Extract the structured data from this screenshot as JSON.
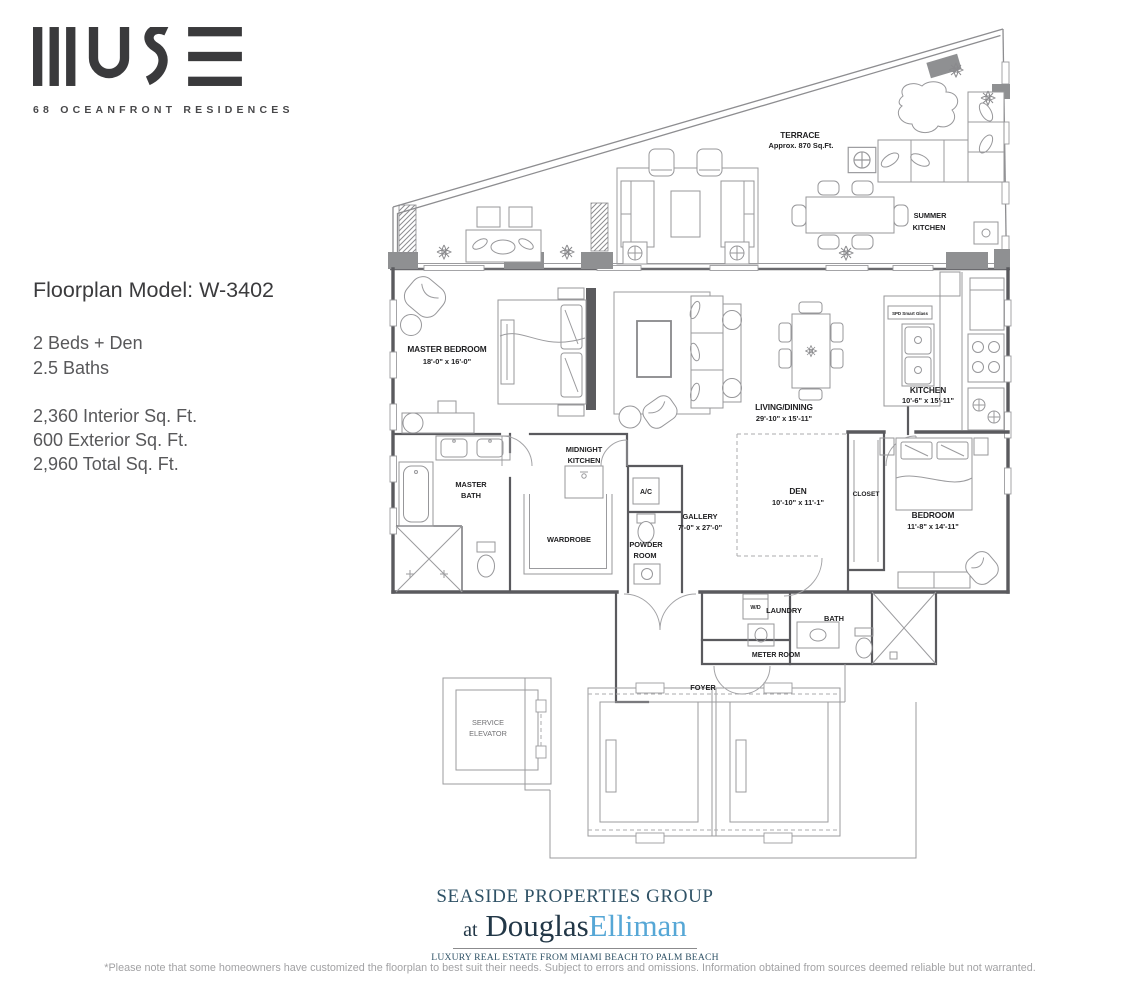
{
  "logo": {
    "brand": "MUSE",
    "tagline": "68 OCEANFRONT RESIDENCES"
  },
  "info": {
    "title": "Floorplan Model: W-3402",
    "beds": "2 Beds + Den",
    "baths": "2.5 Baths",
    "interior_sqft": "2,360 Interior Sq. Ft.",
    "exterior_sqft": "600 Exterior Sq. Ft.",
    "total_sqft": "2,960 Total Sq. Ft."
  },
  "floorplan": {
    "terrace": {
      "name": "TERRACE",
      "area": "Approx. 870 Sq.Ft."
    },
    "summer_kitchen": {
      "line1": "SUMMER",
      "line2": "KITCHEN"
    },
    "master_bedroom": {
      "name": "MASTER BEDROOM",
      "dims": "18'-0\" x 16'-0\""
    },
    "living_dining": {
      "name": "LIVING/DINING",
      "dims": "29'-10\" x 15'-11\""
    },
    "kitchen": {
      "name": "KITCHEN",
      "dims": "10'-6\" x 15'-11\""
    },
    "spd_glass": "SPD Smart Glass",
    "midnight_kitchen": {
      "line1": "MIDNIGHT",
      "line2": "KITCHEN"
    },
    "master_bath": {
      "line1": "MASTER",
      "line2": "BATH"
    },
    "wardrobe": "WARDROBE",
    "ac": "A/C",
    "powder_room": {
      "line1": "POWDER",
      "line2": "ROOM"
    },
    "gallery": {
      "name": "GALLERY",
      "dims": "7'-0\" x 27'-0\""
    },
    "den": {
      "name": "DEN",
      "dims": "10'-10\" x 11'-1\""
    },
    "closet": "CLOSET",
    "bedroom": {
      "name": "BEDROOM",
      "dims": "11'-8\" x 14'-11\""
    },
    "wd": "W/D",
    "laundry": "LAUNDRY",
    "bath": "BATH",
    "meter_room": "METER ROOM",
    "foyer": "FOYER",
    "service_elevator": {
      "line1": "SERVICE",
      "line2": "ELEVATOR"
    }
  },
  "branding": {
    "group": "SEASIDE PROPERTIES GROUP",
    "at": "at",
    "douglas": "Douglas",
    "elliman": "Elliman",
    "tagline": "LUXURY REAL ESTATE FROM MIAMI BEACH TO PALM BEACH",
    "colors": {
      "group_teal": "#2f5266",
      "douglas_navy": "#223747",
      "elliman_blue": "#56a7d6"
    }
  },
  "footer": {
    "disclaimer": "*Please note that some homeowners have customized the floorplan to best suit their needs. Subject to errors and omissions. Information obtained from sources deemed reliable but not warranted."
  }
}
